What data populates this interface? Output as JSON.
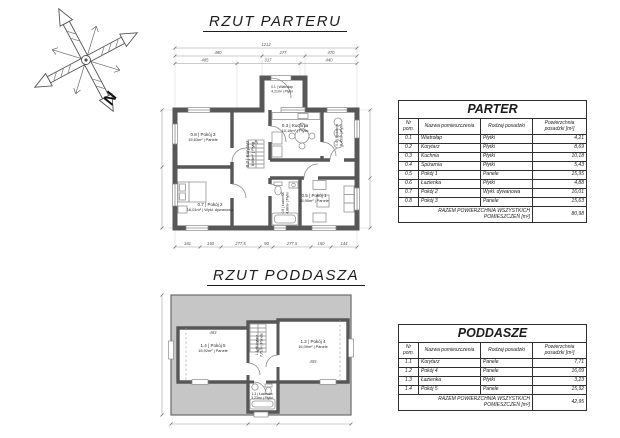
{
  "compass": {
    "north_label": "N"
  },
  "parter": {
    "title": "RZUT PARTERU",
    "dims": {
      "overall_top": "1212",
      "top_row1": [
        "480",
        "277",
        "470"
      ],
      "top_row2": [
        "485",
        "317",
        "440"
      ],
      "bottom": [
        "181",
        "150",
        "277,5",
        "90",
        "277,5",
        "150",
        "144"
      ]
    },
    "rooms": {
      "wiatrolap": {
        "line1": "0.1 | Wiatrołap",
        "line2": "4,21m² | Płytki"
      },
      "korytarz": {
        "line1": "0.2 | Korytarz",
        "line2": "8,69m² | Płytki"
      },
      "kuchnia": {
        "line1": "0.3 | Kuchnia",
        "line2": "10,18m² | Płytki"
      },
      "spizarnia": {
        "line1": "0.4 | Spiżarnia",
        "line2": "5,43m² | Płytki"
      },
      "pokoj1": {
        "line1": "0.5 | Pokój 1",
        "line2": "15,95m² | Panele"
      },
      "lazienka": {
        "line1": "0.6 | Łazienka",
        "line2": "4,88m² | Płytki"
      },
      "pokoj2": {
        "line1": "0.7 | Pokój 2",
        "line2": "16,01m² | Wykł. dywanowa"
      },
      "pokoj3": {
        "line1": "0.8 | Pokój 3",
        "line2": "15,63m² | Panele"
      }
    }
  },
  "poddasze": {
    "title": "RZUT PODDASZA",
    "dims": {
      "room_left": "483",
      "room_right": "455"
    },
    "rooms": {
      "korytarz": {
        "line1": "1.1 | Korytarz",
        "line2": "7,71m² | Panele"
      },
      "pokoj4": {
        "line1": "1.2 | Pokój 4",
        "line2": "16,09m² | Panele"
      },
      "lazienka": {
        "line1": "1.3 | Łazienka",
        "line2": "3,23m² | Płytki"
      },
      "pokoj5": {
        "line1": "1.4 | Pokój 5",
        "line2": "15,92m² | Panele"
      }
    }
  },
  "parter_table": {
    "title": "PARTER",
    "headers": [
      "Nr pom.",
      "Nazwa pomieszczenia",
      "Rodzaj posadzki",
      "Powierzchnia posadzki [m²]"
    ],
    "rows": [
      [
        "0.1",
        "Wiatrołap",
        "Płytki",
        "4,21"
      ],
      [
        "0.2",
        "Korytarz",
        "Płytki",
        "8,69"
      ],
      [
        "0.3",
        "Kuchnia",
        "Płytki",
        "10,18"
      ],
      [
        "0.4",
        "Spiżarnia",
        "Płytki",
        "5,43"
      ],
      [
        "0.5",
        "Pokój 1",
        "Panele",
        "15,95"
      ],
      [
        "0.6",
        "Łazienka",
        "Płytki",
        "4,88"
      ],
      [
        "0.7",
        "Pokój 2",
        "Wykł. dywanowa",
        "16,01"
      ],
      [
        "0.8",
        "Pokój 3",
        "Panele",
        "15,63"
      ]
    ],
    "total_label": "RAZEM POWIERZCHNIA WSZYSTKICH POMIESZCZEŃ [m²]",
    "total_value": "80,98"
  },
  "poddasze_table": {
    "title": "PODDASZE",
    "headers": [
      "Nr pom.",
      "Nazwa pomieszczenia",
      "Rodzaj posadzki",
      "Powierzchnia posadzki [m²]"
    ],
    "rows": [
      [
        "1.1",
        "Korytarz",
        "Panele",
        "7,71"
      ],
      [
        "1.2",
        "Pokój 4",
        "Panele",
        "16,09"
      ],
      [
        "1.3",
        "Łazienka",
        "Płytki",
        "3,23"
      ],
      [
        "1.4",
        "Pokój 5",
        "Panele",
        "15,92"
      ]
    ],
    "total_label": "RAZEM POWIERZCHNIA WSZYSTKICH POMIESZCZEŃ [m²]",
    "total_value": "42,95"
  }
}
